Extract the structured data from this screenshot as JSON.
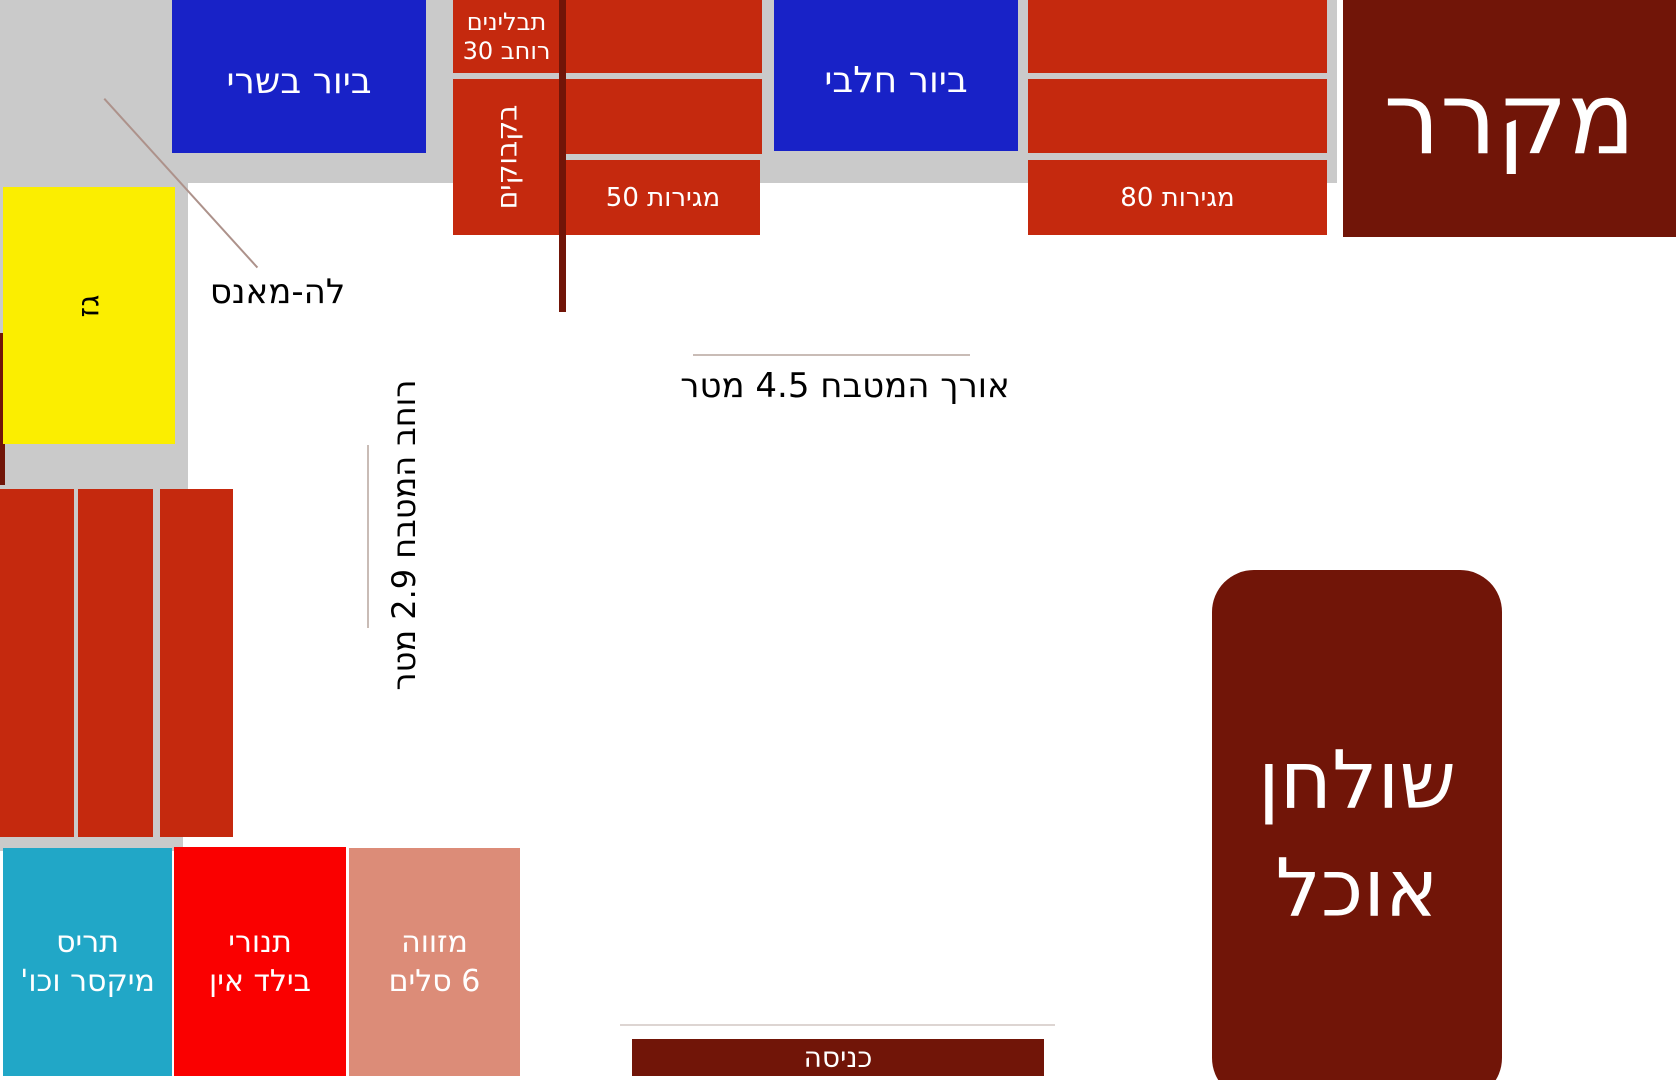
{
  "labels": {
    "sink_meat": "ביור בשרי",
    "spices_line1": "תבלינים",
    "spices_line2": "רוחב 30",
    "bottles": "בקבוקים",
    "drawers_50": "מגירות 50",
    "sink_dairy": "ביור חלבי",
    "drawers_80": "מגירות 80",
    "fridge": "מקרר",
    "gas": "גז",
    "le_mans": "לה-מאנס",
    "kitchen_length": "אורך המטבח 4.5 מטר",
    "kitchen_width": "רוחב המטבח 2.9 מטר",
    "shutter_line1": "תריס",
    "shutter_line2": "מיקסר וכו'",
    "ovens_line1": "תנורי",
    "ovens_line2": "בילד אין",
    "pantry_line1": "מזווה",
    "pantry_line2": "6 סלים",
    "entrance": "כניסה",
    "dining_table_line1": "שולחן",
    "dining_table_line2": "אוכל"
  },
  "colors": {
    "cabinet_red": "#c5290e",
    "maroon": "#711508",
    "blue": "#1822c7",
    "yellow": "#fbee00",
    "cyan": "#21a7c7",
    "oven_red": "#fa0000",
    "salmon": "#dc8c78",
    "counter_gray": "#cacaca",
    "pointer_line": "#ad928b",
    "dim_line": "#c9bcb6",
    "text_black": "#000000",
    "text_white": "#ffffff"
  }
}
